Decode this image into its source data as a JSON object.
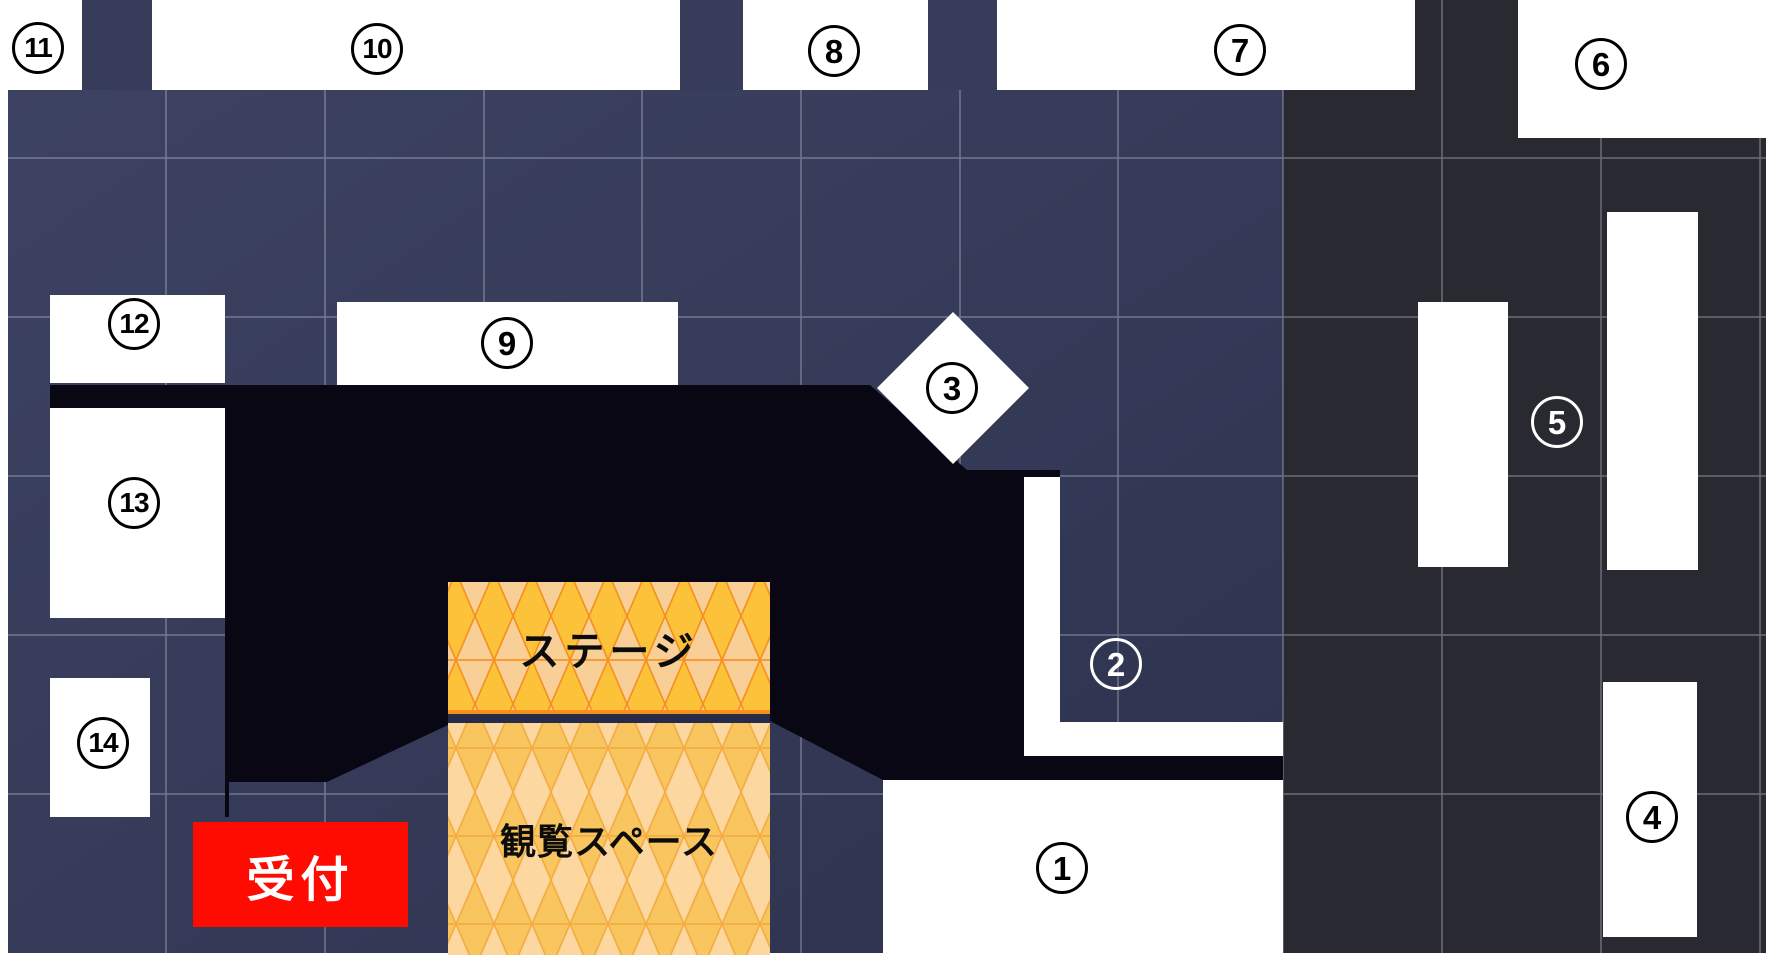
{
  "floor_plan": {
    "reception": {
      "label": "受付"
    },
    "stage": {
      "label": "ステージ"
    },
    "audience_area": {
      "label": "観覧スペース"
    },
    "booths": [
      {
        "number": "1",
        "badge": "black-on-white"
      },
      {
        "number": "2",
        "badge": "white-outline"
      },
      {
        "number": "3",
        "badge": "black-on-white"
      },
      {
        "number": "4",
        "badge": "black-on-white"
      },
      {
        "number": "5",
        "badge": "white-outline"
      },
      {
        "number": "6",
        "badge": "black-on-white"
      },
      {
        "number": "7",
        "badge": "black-on-white"
      },
      {
        "number": "8",
        "badge": "black-on-white"
      },
      {
        "number": "9",
        "badge": "black-on-white"
      },
      {
        "number": "10",
        "badge": "black-on-white"
      },
      {
        "number": "11",
        "badge": "black-on-white"
      },
      {
        "number": "12",
        "badge": "black-on-white"
      },
      {
        "number": "13",
        "badge": "black-on-white"
      },
      {
        "number": "14",
        "badge": "black-on-white"
      }
    ],
    "colors": {
      "floor-navy": "#353b58",
      "floor-navy-light": "#3d4263",
      "floor-navy-deep": "#2d324e",
      "floor-dark": "#292a31",
      "zone-black": "#0a0714",
      "stage-gold": "#fcc33a",
      "stage-tri-light": "#f8cf96",
      "stage-line": "#f78f1e",
      "audience-peach": "#fcd8a0",
      "audience-tri-gold": "#f9c55e",
      "audience-line": "#f3ab42",
      "stage-divider": "#262b4a",
      "reception-red": "#fe0b02",
      "grid-line": "#c6cadb",
      "booth-white": "#ffffff",
      "badge-black": "#000000"
    }
  }
}
